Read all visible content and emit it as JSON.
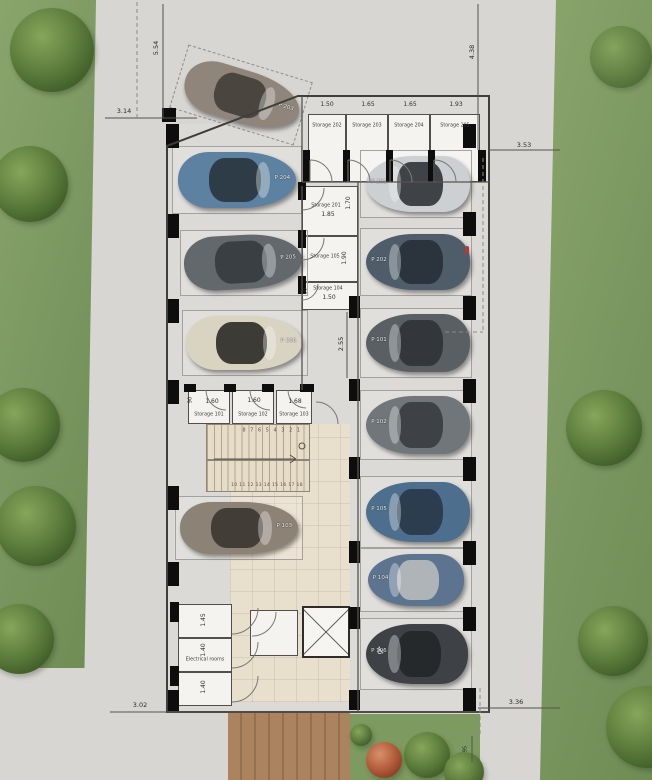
{
  "title": "Basement parking floor plan",
  "palette": {
    "grass": "#7e9a62",
    "concrete": "#d7d6d3",
    "floor": "#dcdad6",
    "lobby_tile": "#e9dfcd",
    "wood_deck": "#a9815f",
    "wall": "#0d0d0d",
    "room": "#f4f3f0"
  },
  "dimensions": {
    "site_left_vertical": "5.54",
    "site_top_left": "3.14",
    "site_right_vertical": "4.38",
    "site_right": "3.53",
    "aisle_vertical": "2.55",
    "site_bottom_left": "3.02",
    "site_bottom_right": "3.36",
    "garden_vertical": "95"
  },
  "storage_rooms": {
    "s202": {
      "label": "Storage 202",
      "dim": "1.50"
    },
    "s203": {
      "label": "Storage 203",
      "dim": "1.65"
    },
    "s204": {
      "label": "Storage 204",
      "dim": "1.65"
    },
    "s205": {
      "label": "Storage 205",
      "dim": "1.93"
    },
    "s201": {
      "label": "Storage 201",
      "dim": "1.85",
      "side_dim": "1.70"
    },
    "s105": {
      "label": "Storage 105",
      "side_dim": "1.90"
    },
    "s104": {
      "label": "Storage 104",
      "dim": "1.50",
      "side_dim": "80"
    },
    "s101": {
      "label": "Storage 101",
      "dim": "1.60",
      "side_dim": "90"
    },
    "s102": {
      "label": "Storage 102",
      "dim": "1.60"
    },
    "s103": {
      "label": "Storage 103",
      "dim": "1.68"
    }
  },
  "electrical": {
    "label": "Electrical rooms",
    "room_dims": [
      "1.45",
      "1.40",
      "1.40"
    ]
  },
  "stairs": {
    "upper_run": "8 7 6 5 4 3 2 1",
    "lower_run": "10 11 12 13 14 15 16 17 18"
  },
  "cars": {
    "c1": {
      "label": "P 203",
      "color": "#8f857a",
      "roof": "#4a453f"
    },
    "c2": {
      "label": "P 204",
      "color": "#5d81a0",
      "roof": "#2e3c48"
    },
    "c3": {
      "label": "P 205",
      "color": "#63686c",
      "roof": "#3a3f43"
    },
    "c4": {
      "label": "P 206",
      "color": "#d9d3c2",
      "roof": "#3c3b36"
    },
    "c5": {
      "label": "P 103",
      "color": "#8c8275",
      "roof": "#423e37"
    },
    "r1": {
      "label": "P 201",
      "color": "#ccd0d2",
      "roof": "#3f4347"
    },
    "r2": {
      "label": "P 202",
      "color": "#4f5d6b",
      "roof": "#2b333c"
    },
    "r3": {
      "label": "P 101",
      "color": "#5a5f64",
      "roof": "#33373b"
    },
    "r4": {
      "label": "P 102",
      "color": "#71767a",
      "roof": "#3e4246"
    },
    "r5": {
      "label": "P 105",
      "color": "#4e6e8d",
      "roof": "#2b3d4e"
    },
    "r6": {
      "label": "P 104",
      "color": "#5d7490",
      "roof": "#aeb4b8"
    },
    "r7": {
      "label": "P 106",
      "color": "#3e4246",
      "roof": "#26292c"
    }
  },
  "icons": {
    "accessible": "♿"
  }
}
